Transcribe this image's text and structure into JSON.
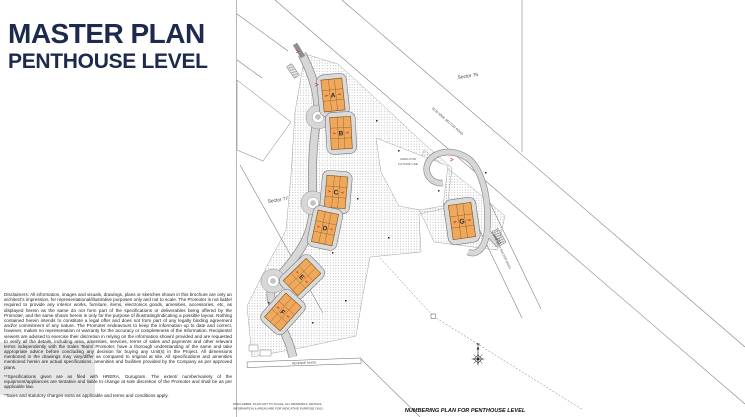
{
  "header": {
    "title_line1": "MASTER PLAN",
    "title_line2": "PENTHOUSE LEVEL",
    "title_color": "#1d2a4d"
  },
  "disclaimer": {
    "para1": "Disclaimers: All information, images and visuals, drawings, plans or sketches shown in this brochure are only an architect's impression, for representational/illustrative purposes only and not to scale. The Promoter is not liable/ required to provide any interior works, furniture, items, electronics goods, amenities, accessories, etc, as displayed herein as the same do not form part of the specifications or deliverables being offered by the Promoter, and the same shown herein is only for the purpose of illustrating/indicating a possible layout. Nothing contained herein intends to constitute a legal offer and does not form part of any legally binding agreement and/or commitment of any nature. The Promoter endeavours to keep the information up to date and correct, however, makes no representation or warranty for the accuracy or completeness of the Information. Recipients/ viewers are advised to exercise their discretion in relying on the information shown/ provided and are requested to verify all the details, including area, amenities, services, terms of sales and payments and other relevant terms independently with the Sales Team/ Promoter, have a thorough understanding of the same and take appropriate advice before concluding any decision for buying any Unit(s) in the Project. All dimensions mentioned in the drawings may vary/differ as compared to original at site. All specifications and amenities mentioned herein are actual specifications, amenities and facilities provided by the Company as per approved plans.",
    "para2": "**Specifications given are as filed with HRERA, Gurugram. The extent/ number/variety of the equipment/appliances are tentative and liable to change at sole discretion of the Promoter and shall be as per applicable law.",
    "para3": "*Taxes and statutory charges extra as applicable and terms and conditions apply."
  },
  "plan": {
    "caption": "NUMBERING PLAN FOR PENTHOUSE LEVEL",
    "plan_disclaimer_line1": "DISCLAIMER: PLAN NOT TO SCALE. ALL DRAWINGS, DETAILS,",
    "plan_disclaimer_line2": "INFORMATION & AREAS ARE FOR INDICATIVE PURPOSE ONLY.",
    "sector_label_1": "Sector 76",
    "sector_label_2": "Sector 77",
    "road_label_1": "60 M WIDE SECTOR ROAD",
    "road_label_2": "24 M WIDE SECTOR ROAD",
    "future_use_line1": "AREA FOR",
    "future_use_line2": "FUTURE USE",
    "revenue_rasta_label": "REVENUE RASTA",
    "compass_label": "N",
    "buildings": [
      {
        "label": "A"
      },
      {
        "label": "B"
      },
      {
        "label": "C"
      },
      {
        "label": "D"
      },
      {
        "label": "E"
      },
      {
        "label": "F"
      },
      {
        "label": "G"
      }
    ],
    "colors": {
      "building_fill": "#f0a85d",
      "building_stroke": "#7a5418",
      "plot_fill": "#dadada",
      "road_fill": "#d7d7d7",
      "accent_red": "#cf3a2b",
      "line": "#6e6e6e"
    }
  }
}
